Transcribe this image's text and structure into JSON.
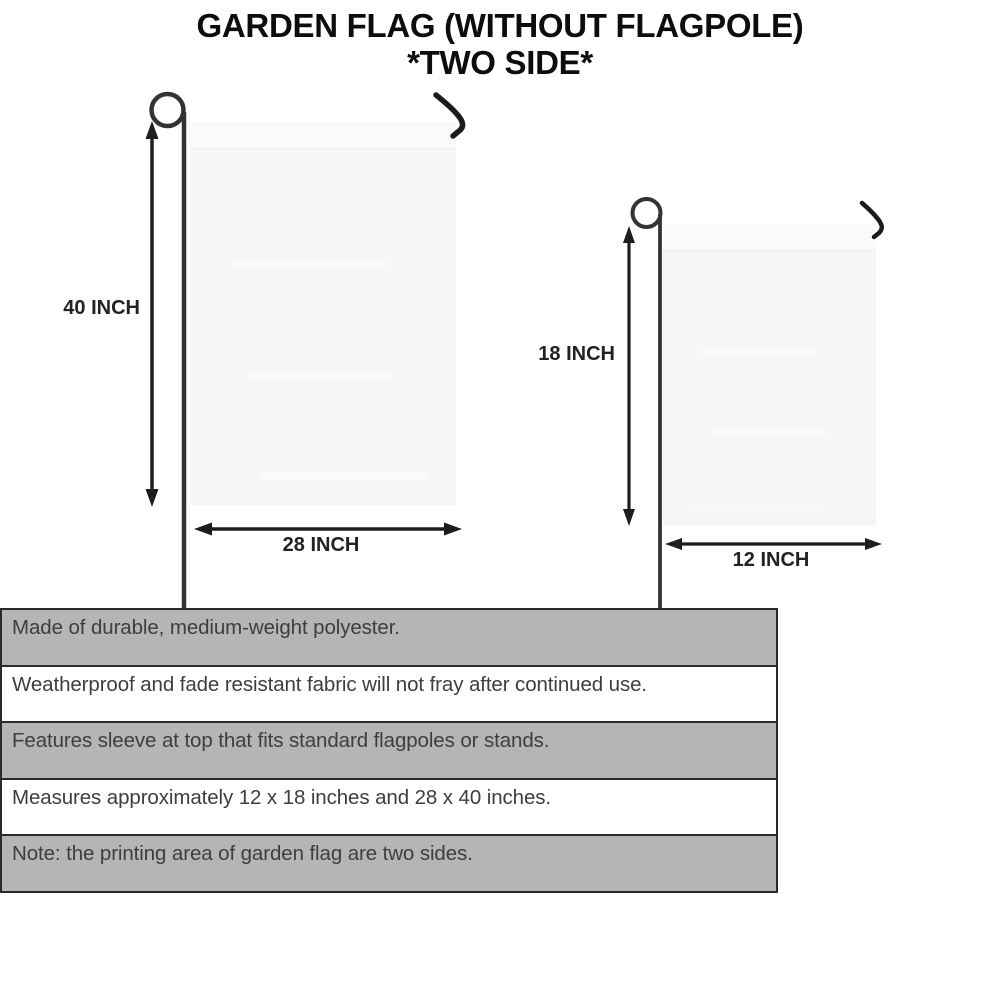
{
  "title": {
    "line1": "GARDEN FLAG (WITHOUT FLAGPOLE)",
    "line2": "*TWO SIDE*"
  },
  "large_flag": {
    "height_label": "40 INCH",
    "width_label": "28 INCH"
  },
  "small_flag": {
    "height_label": "18 INCH",
    "width_label": "12 INCH"
  },
  "features": [
    "Made of durable, medium-weight polyester.",
    "Weatherproof and fade resistant fabric will not fray after continued use.",
    "Features sleeve at top that fits standard flagpoles or stands.",
    "Measures approximately 12 x 18 inches and 28 x 40 inches.",
    "Note: the printing area of garden flag are two sides."
  ],
  "colors": {
    "row_gray": "#b5b5b5",
    "row_white": "#ffffff",
    "table_border": "#2a2a2a",
    "body_text": "#3e3e3e",
    "title_text": "#0d0d0d",
    "pole": "#333333",
    "arrow": "#1d1d1d",
    "flag_fill": "#f6f6f7"
  }
}
